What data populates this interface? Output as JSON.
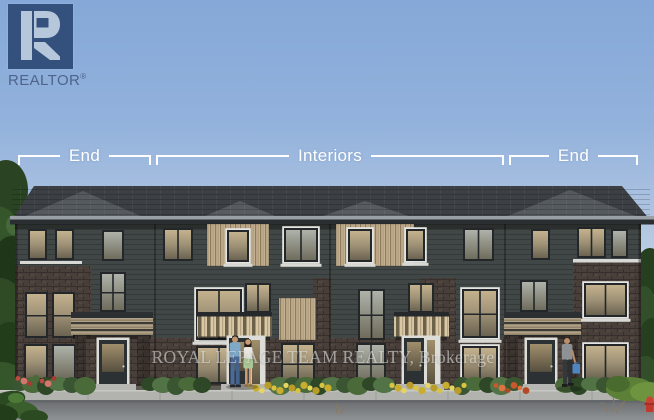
{
  "realtor_logo": {
    "text": "REALTOR",
    "registered": "®"
  },
  "plan_annotation": {
    "sections": [
      {
        "label": "End"
      },
      {
        "label": "Interiors"
      },
      {
        "label": "End"
      }
    ]
  },
  "watermark": {
    "text": "ROYAL LEPAGE TEAM REALTY, Brokerage"
  },
  "scene": {
    "subject": "3-storey townhome block rendering with four units",
    "colors": {
      "sky_top": "#85a8d8",
      "sky_horizon": "#e7ecf3",
      "roof_gray": "#555a5e",
      "siding_dark": "#414746",
      "brick_dark": "#483f3a",
      "accent_tan": "#c2b092",
      "annotation_white": "#ffffff",
      "watermark_gray": "#f0f0ee",
      "logo_navy": "#33517c",
      "logo_light_blue": "#b7c7db",
      "hedge_green": "#3a5531",
      "flower_yellow": "#d9c43f",
      "flower_red": "#bf4a42",
      "sidewalk_gray": "#b2b3af",
      "road_gray": "#7d8082"
    }
  }
}
